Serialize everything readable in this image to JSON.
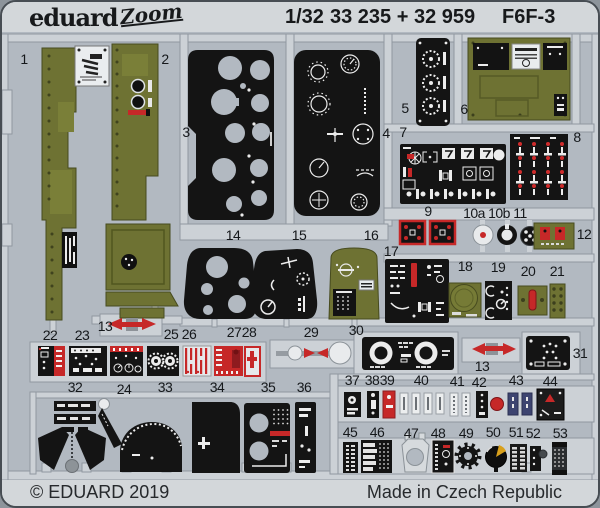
{
  "header": {
    "brand": "eduard",
    "logo_script": "Zoom",
    "scale": "1/32",
    "catalog": "33 235 + 32 959",
    "product": "F6F-3"
  },
  "footer": {
    "copyright": "© EDUARD 2019",
    "made_in": "Made in Czech Republic"
  },
  "colors": {
    "card": "#d3d7da",
    "photo_background": "#b2b9c1",
    "fret_rail": "#ccd1d6",
    "olive_paint": "#6e7233",
    "black_part": "#141414",
    "red_part": "#c62828",
    "white_print": "#ececec"
  },
  "photo": {
    "description_labels_total": 55,
    "part_labels": [
      {
        "id": "1",
        "x": 22,
        "y": 57
      },
      {
        "id": "2",
        "x": 163,
        "y": 57
      },
      {
        "id": "3",
        "x": 184,
        "y": 130
      },
      {
        "id": "4",
        "x": 384,
        "y": 131
      },
      {
        "id": "5",
        "x": 403,
        "y": 106
      },
      {
        "id": "6",
        "x": 462,
        "y": 107
      },
      {
        "id": "7",
        "x": 401,
        "y": 130
      },
      {
        "id": "8",
        "x": 575,
        "y": 135
      },
      {
        "id": "9",
        "x": 426,
        "y": 209
      },
      {
        "id": "10a",
        "x": 472,
        "y": 211
      },
      {
        "id": "10b",
        "x": 497,
        "y": 211
      },
      {
        "id": "11",
        "x": 518,
        "y": 211
      },
      {
        "id": "12",
        "x": 582,
        "y": 232
      },
      {
        "id": "13",
        "x": 103,
        "y": 324
      },
      {
        "id": "13",
        "key": "13b",
        "x": 480,
        "y": 364
      },
      {
        "id": "14",
        "x": 231,
        "y": 233
      },
      {
        "id": "15",
        "x": 297,
        "y": 233
      },
      {
        "id": "16",
        "x": 369,
        "y": 233
      },
      {
        "id": "17",
        "x": 389,
        "y": 249
      },
      {
        "id": "18",
        "x": 463,
        "y": 264
      },
      {
        "id": "19",
        "x": 496,
        "y": 265
      },
      {
        "id": "20",
        "x": 526,
        "y": 269
      },
      {
        "id": "21",
        "x": 555,
        "y": 269
      },
      {
        "id": "22",
        "x": 48,
        "y": 333
      },
      {
        "id": "23",
        "x": 80,
        "y": 333
      },
      {
        "id": "24",
        "x": 122,
        "y": 387
      },
      {
        "id": "25",
        "x": 169,
        "y": 332
      },
      {
        "id": "26",
        "x": 187,
        "y": 332
      },
      {
        "id": "27",
        "x": 232,
        "y": 330
      },
      {
        "id": "28",
        "x": 247,
        "y": 330
      },
      {
        "id": "29",
        "x": 309,
        "y": 330
      },
      {
        "id": "30",
        "x": 354,
        "y": 328
      },
      {
        "id": "31",
        "x": 578,
        "y": 351
      },
      {
        "id": "32",
        "x": 73,
        "y": 385
      },
      {
        "id": "33",
        "x": 163,
        "y": 385
      },
      {
        "id": "34",
        "x": 215,
        "y": 385
      },
      {
        "id": "35",
        "x": 266,
        "y": 385
      },
      {
        "id": "36",
        "x": 302,
        "y": 385
      },
      {
        "id": "37",
        "x": 350,
        "y": 378
      },
      {
        "id": "38",
        "x": 370,
        "y": 378
      },
      {
        "id": "39",
        "x": 385,
        "y": 378
      },
      {
        "id": "40",
        "x": 419,
        "y": 378
      },
      {
        "id": "41",
        "x": 455,
        "y": 379
      },
      {
        "id": "42",
        "x": 477,
        "y": 380
      },
      {
        "id": "43",
        "x": 514,
        "y": 378
      },
      {
        "id": "44",
        "x": 548,
        "y": 379
      },
      {
        "id": "45",
        "x": 348,
        "y": 430
      },
      {
        "id": "46",
        "x": 375,
        "y": 430
      },
      {
        "id": "47",
        "x": 409,
        "y": 431
      },
      {
        "id": "48",
        "x": 436,
        "y": 431
      },
      {
        "id": "49",
        "x": 464,
        "y": 431
      },
      {
        "id": "50",
        "x": 491,
        "y": 430
      },
      {
        "id": "51",
        "x": 514,
        "y": 430
      },
      {
        "id": "52",
        "x": 531,
        "y": 431
      },
      {
        "id": "53",
        "x": 558,
        "y": 431
      }
    ]
  }
}
